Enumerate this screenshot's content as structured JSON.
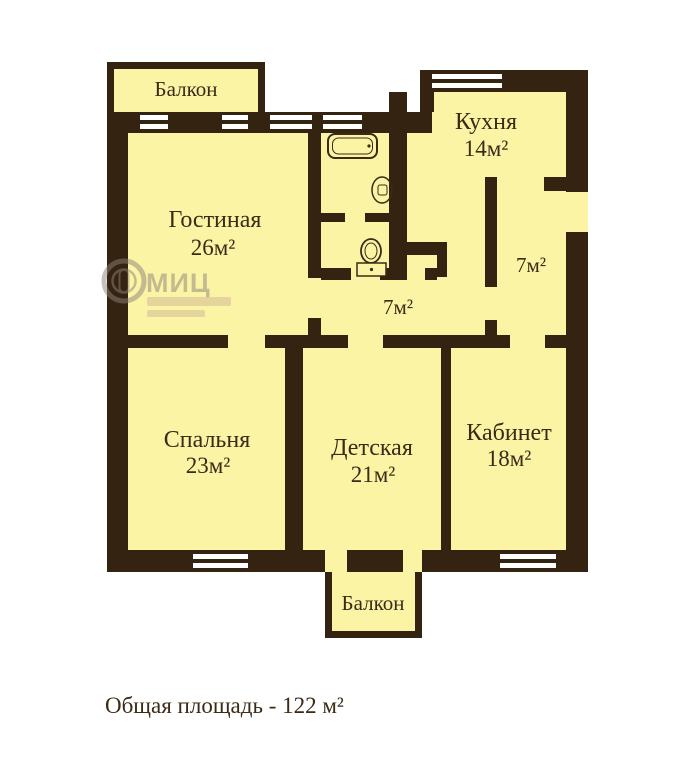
{
  "colors": {
    "wall": "#352312",
    "floor": "#FAF4A4",
    "window": "#FFFFFF",
    "text": "#3A2A16",
    "watermark": "#8D827B",
    "watermark_accent": "#B5908E"
  },
  "rooms": {
    "balcony_top": {
      "label": "Балкон"
    },
    "living": {
      "label": "Гостиная",
      "area": "26м²"
    },
    "kitchen": {
      "label": "Кухня",
      "area": "14м²"
    },
    "hall_entry": {
      "area": "7м²"
    },
    "hall_corridor": {
      "area": "7м²"
    },
    "bedroom": {
      "label": "Спальня",
      "area": "23м²"
    },
    "nursery": {
      "label": "Детская",
      "area": "21м²"
    },
    "office": {
      "label": "Кабинет",
      "area": "18м²"
    },
    "balcony_bottom": {
      "label": "Балкон"
    }
  },
  "fixtures": {
    "bathtub": "bathtub-icon",
    "sink": "sink-icon",
    "toilet": "toilet-icon"
  },
  "watermark": {
    "brand": "МИЦ"
  },
  "caption": {
    "total_area": "Общая площадь - 122 м²"
  }
}
